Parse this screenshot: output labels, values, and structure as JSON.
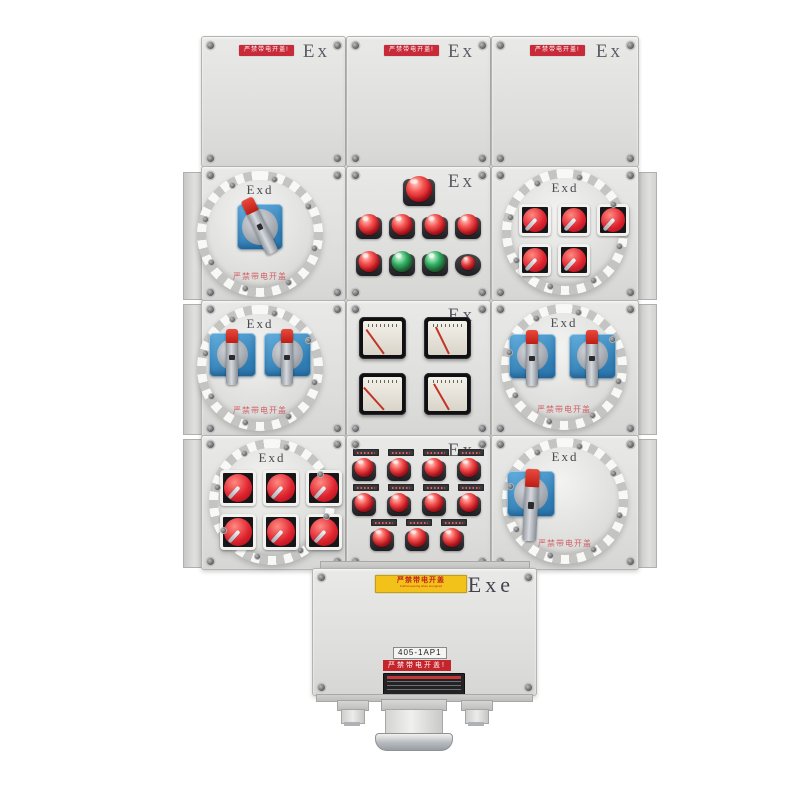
{
  "labels": {
    "ex": "Ex",
    "exd": "Exd",
    "exe": "Exe",
    "top_warning": "严禁带电开盖!",
    "cover_warning": "严禁带电开盖",
    "yellow_warning_cn": "严禁带电开盖",
    "yellow_warning_en": "Forbid opening when energized",
    "tag": "405-1AP1",
    "bottom_red_strip": "严禁带电开盖!"
  },
  "colors": {
    "enclosure": "#e4e4e2",
    "warning_red": "#c82a3a",
    "switch_plate_blue": "#3f8ec6",
    "lamp_red": "#cf1622",
    "button_green": "#149149",
    "handle_tip_red": "#d42a1f",
    "label_yellow": "#f2c21a"
  },
  "modules": {
    "row2_mid": {
      "top_lights": 1,
      "indicator_row_colors": "red,red,red,red",
      "button_row_colors": "red,green,green,redsmall"
    },
    "row2_right_toggles": {
      "rows": [
        3,
        2
      ]
    },
    "row3_meters": {
      "count": 4,
      "needle_angles": [
        -36,
        -26,
        -42,
        -30
      ]
    },
    "row4_left_toggles": {
      "rows": [
        3,
        3
      ]
    },
    "row4_mid_lights": {
      "rows": [
        4,
        4,
        3
      ]
    },
    "rotaries": {
      "row2_left": 1,
      "row3_left": 2,
      "row3_right": 2,
      "row4_right": 1
    }
  }
}
